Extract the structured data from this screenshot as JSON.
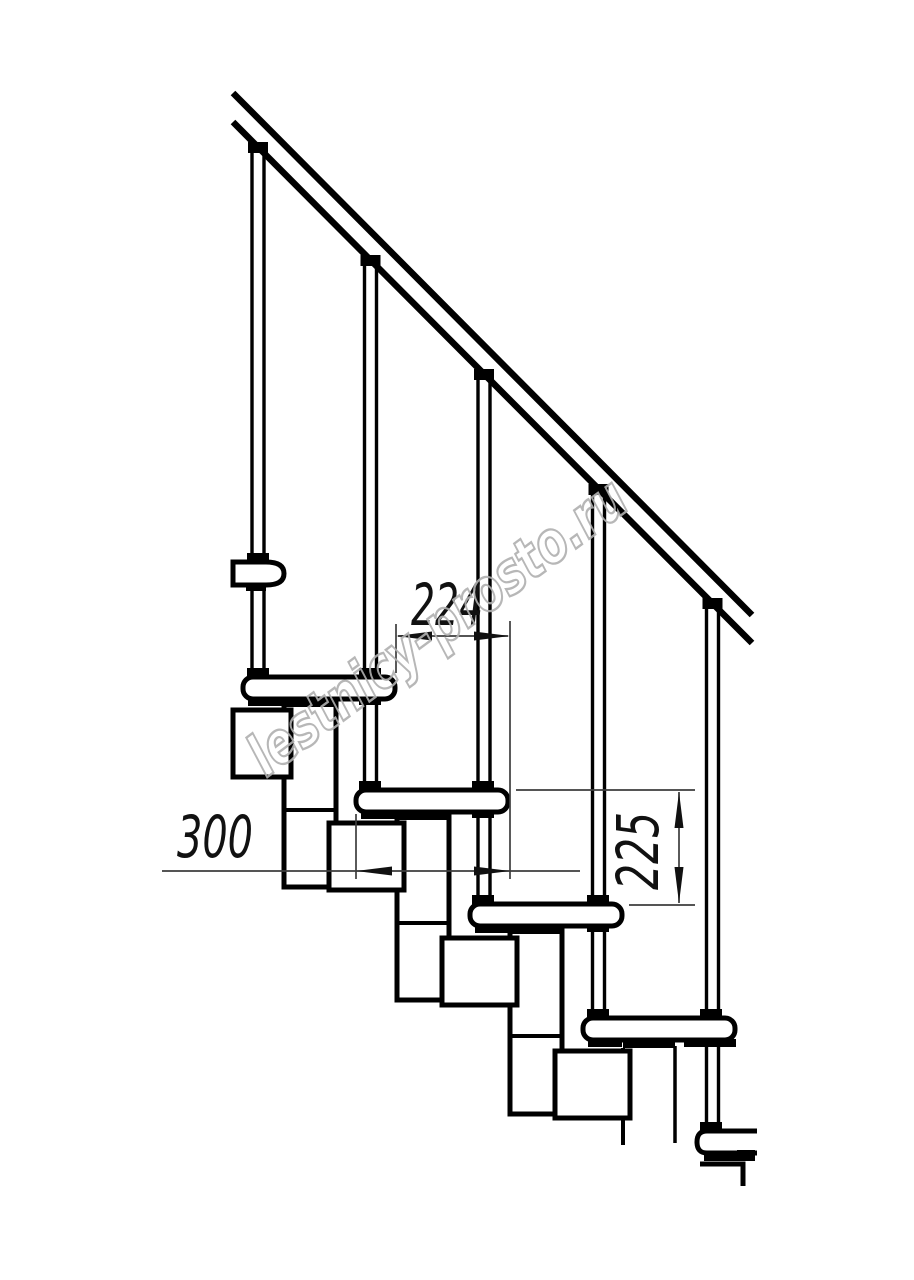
{
  "drawing": {
    "type": "staircase-side-view-technical-drawing",
    "dimensions": {
      "run": {
        "value": "224",
        "orientation": "horizontal"
      },
      "tread_depth": {
        "value": "300",
        "orientation": "horizontal"
      },
      "rise": {
        "value": "225",
        "orientation": "vertical"
      }
    },
    "watermark": {
      "text": "lestnicy-prosto.ru",
      "color": "#b0b0b0"
    },
    "colors": {
      "background": "#ffffff",
      "line": "#000000",
      "dimension_line": "#3d3d3d"
    }
  }
}
